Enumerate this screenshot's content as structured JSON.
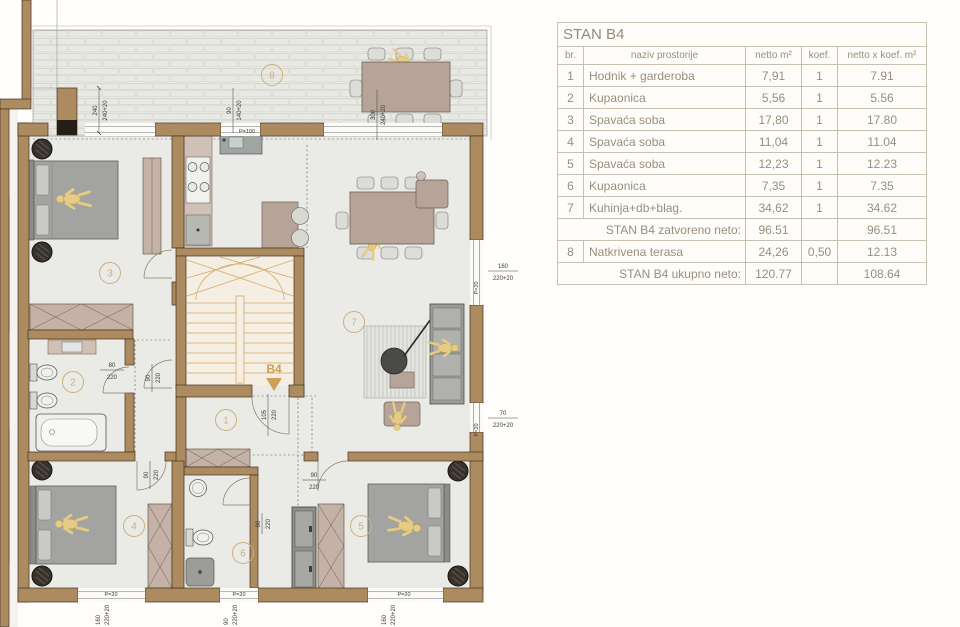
{
  "plan": {
    "unit": "B4",
    "markers": {
      "m1": "1",
      "m2": "2",
      "m3": "3",
      "m4": "4",
      "m5": "5",
      "m6": "6",
      "m7": "7",
      "m8": "8"
    },
    "window_labels": {
      "p100": "P=100",
      "p20": "P=20"
    },
    "dims": {
      "terrace_door": {
        "a": "240",
        "b": "240+20"
      },
      "kitchen_win": {
        "a": "90",
        "b": "140+20"
      },
      "terrace_open": {
        "a": "300",
        "b": "240+20"
      },
      "living_win": {
        "a": "160",
        "b": "220+20"
      },
      "small_win": {
        "a": "70",
        "b": "220+20"
      },
      "bath2_door": {
        "a": "80",
        "b": "220"
      },
      "hall_door": {
        "a": "90",
        "b": "220"
      },
      "entry_door": {
        "a": "105",
        "b": "220"
      },
      "room4_door": {
        "a": "90",
        "b": "220"
      },
      "room5_door": {
        "a": "90",
        "b": "220"
      },
      "bath6_door": {
        "a": "80",
        "b": "220"
      },
      "bottom_win1": {
        "a": "160",
        "b": "220+20"
      },
      "bottom_win2": {
        "a": "90",
        "b": "220+20"
      },
      "bottom_win3": {
        "a": "160",
        "b": "220+20"
      }
    }
  },
  "table": {
    "title": "STAN B4",
    "columns": {
      "br": "br.",
      "naziv": "naziv prostorije",
      "netto": "netto m²",
      "koef": "koef.",
      "total": "netto x koef. m²"
    },
    "rows": [
      {
        "br": "1",
        "naziv": "Hodnik + garderoba",
        "netto": "7,91",
        "koef": "1",
        "total": "7.91"
      },
      {
        "br": "2",
        "naziv": "Kupaonica",
        "netto": "5,56",
        "koef": "1",
        "total": "5.56"
      },
      {
        "br": "3",
        "naziv": "Spavaća soba",
        "netto": "17,80",
        "koef": "1",
        "total": "17.80"
      },
      {
        "br": "4",
        "naziv": "Spavaća soba",
        "netto": "11,04",
        "koef": "1",
        "total": "11.04"
      },
      {
        "br": "5",
        "naziv": "Spavaća soba",
        "netto": "12,23",
        "koef": "1",
        "total": "12.23"
      },
      {
        "br": "6",
        "naziv": "Kupaonica",
        "netto": "7,35",
        "koef": "1",
        "total": "7.35"
      },
      {
        "br": "7",
        "naziv": "Kuhinja+db+blag.",
        "netto": "34,62",
        "koef": "1",
        "total": "34.62"
      },
      {
        "br": "8",
        "naziv": "Natkrivena terasa",
        "netto": "24,26",
        "koef": "0,50",
        "total": "12.13"
      }
    ],
    "subtotal": {
      "label": "STAN B4 zatvoreno neto:",
      "netto": "96.51",
      "koef": "",
      "total": "96.51"
    },
    "total_row": {
      "label": "STAN B4 ukupno neto:",
      "netto": "120.77",
      "koef": "",
      "total": "108.64"
    }
  }
}
